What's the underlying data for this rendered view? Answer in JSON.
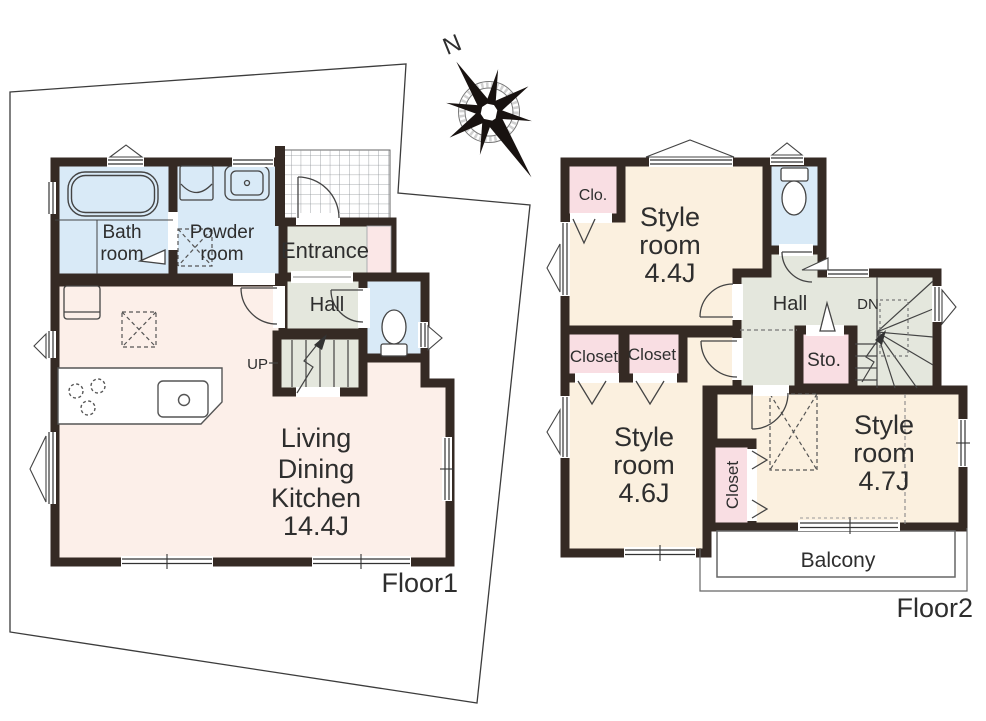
{
  "compass": {
    "north_label": "N"
  },
  "floor1": {
    "label": "Floor1",
    "rooms": {
      "bath": {
        "l1": "Bath",
        "l2": "room"
      },
      "powder": {
        "l1": "Powder",
        "l2": "room"
      },
      "entrance": {
        "label": "Entrance"
      },
      "hall": {
        "label": "Hall"
      },
      "stairs": {
        "label": "UP"
      },
      "ldk": {
        "l1": "Living",
        "l2": "Dining",
        "l3": "Kitchen",
        "l4": "14.4J"
      }
    }
  },
  "floor2": {
    "label": "Floor2",
    "rooms": {
      "clo": {
        "label": "Clo."
      },
      "style44": {
        "l1": "Style",
        "l2": "room",
        "l3": "4.4J"
      },
      "hall": {
        "label": "Hall"
      },
      "stairs": {
        "label": "DN"
      },
      "sto": {
        "label": "Sto."
      },
      "closet1": {
        "label": "Closet"
      },
      "closet2": {
        "label": "Closet"
      },
      "style46": {
        "l1": "Style",
        "l2": "room",
        "l3": "4.6J"
      },
      "closet3": {
        "label": "Closet"
      },
      "style47": {
        "l1": "Style",
        "l2": "room",
        "l3": "4.7J"
      },
      "balcony": {
        "label": "Balcony"
      }
    }
  },
  "colors": {
    "wall": "#352a24",
    "water_rooms": "#d9eaf7",
    "hallway": "#e4e7dd",
    "style_rooms": "#fbf0df",
    "ldk": "#fcefe9",
    "closets": "#f9dee3",
    "shoe_cabinet": "#fbe7e7",
    "line": "#444444"
  }
}
